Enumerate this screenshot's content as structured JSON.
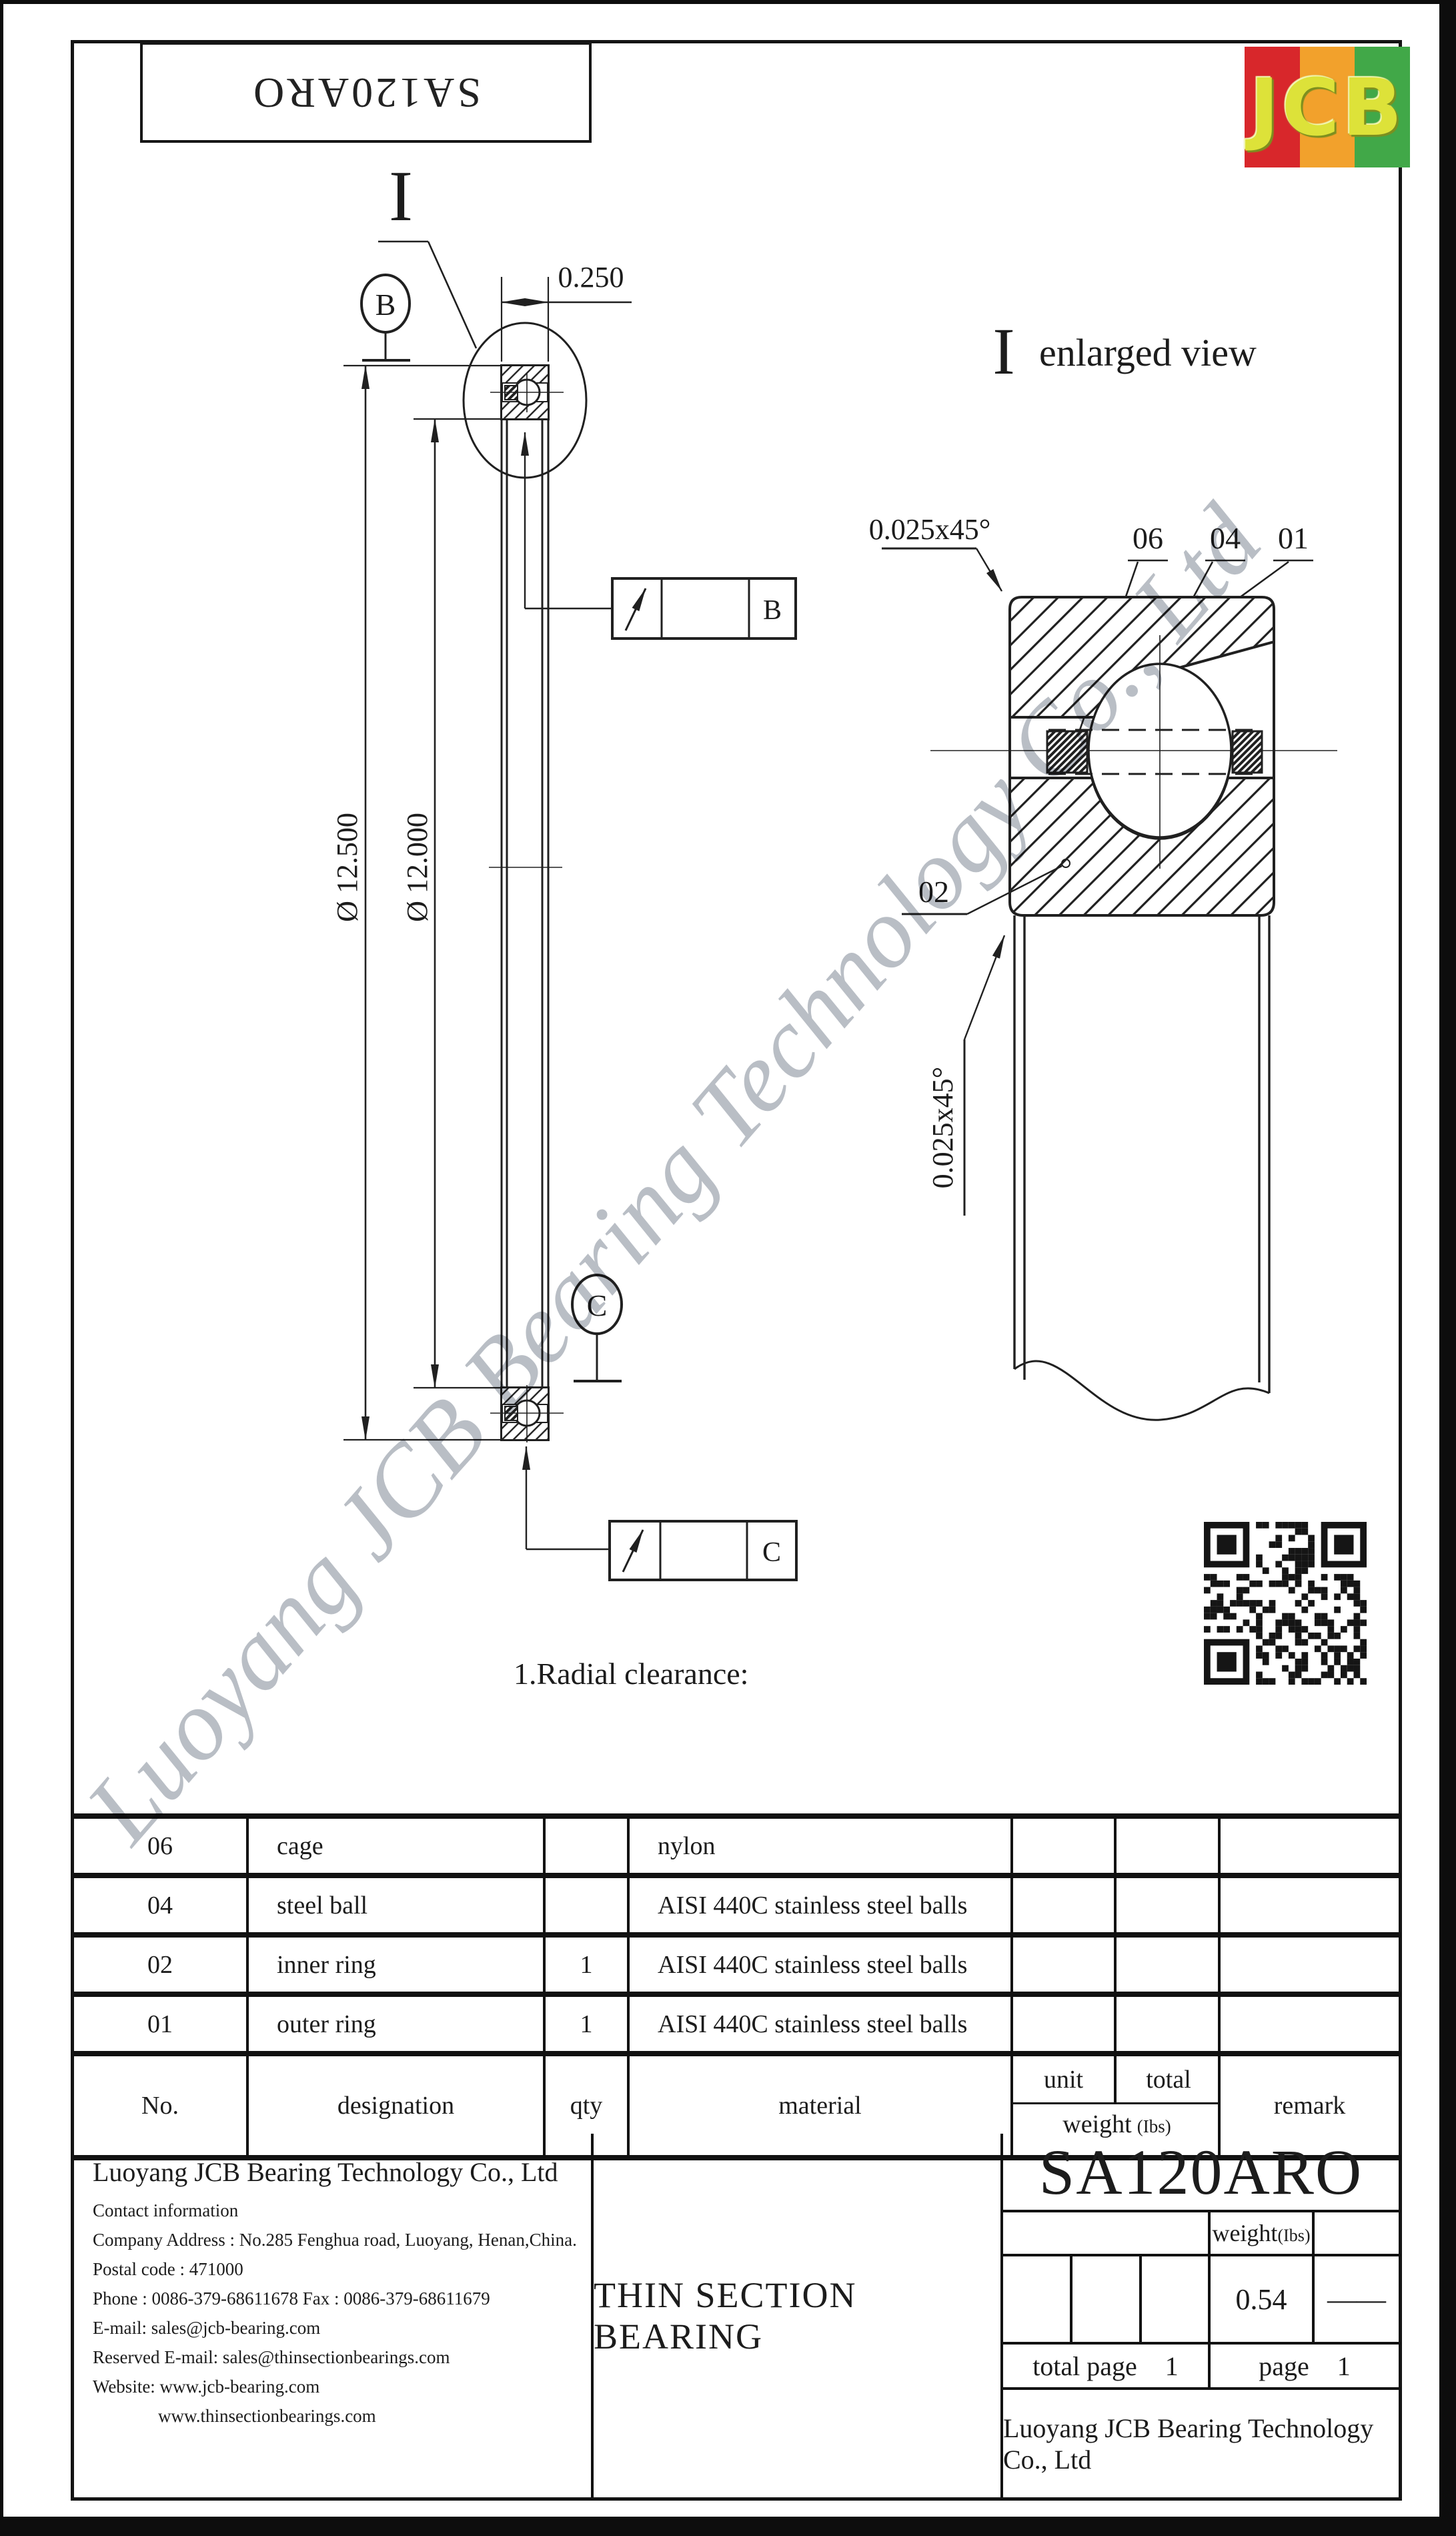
{
  "sheet": {
    "part_number_reversed": "SA120ARO",
    "logo_text": "JCB",
    "logo_stripe_colors": [
      "#d8272b",
      "#f2a12c",
      "#41a848"
    ],
    "logo_letter_color": "#dde239",
    "watermark": "Luoyang JCB Bearing Technology Co., Ltd"
  },
  "left_view": {
    "section_mark": "I",
    "balloon_b": "B",
    "balloon_c": "C",
    "flag_b_label": "B",
    "flag_c_label": "C",
    "dim_width": "0.250",
    "dim_outer_diameter": "Ø 12.500",
    "dim_bore_diameter": "Ø 12.000"
  },
  "enlarged_view": {
    "title_mark": "I",
    "title_text": "enlarged view",
    "chamfer_note_top": "0.025x45°",
    "chamfer_note_side": "0.025x45°",
    "label_cage": "06",
    "label_ball": "04",
    "label_outer_ring": "01",
    "label_inner_ring": "02"
  },
  "notes": {
    "radial_clearance": "1.Radial clearance:"
  },
  "parts_table": {
    "header": {
      "no": "No.",
      "designation": "designation",
      "qty": "qty",
      "material": "material",
      "unit": "unit",
      "total": "total",
      "weight": "weight",
      "weight_unit": "(Ibs)",
      "remark": "remark"
    },
    "rows": [
      {
        "no": "06",
        "designation": "cage",
        "qty": "",
        "material": "nylon",
        "remark": ""
      },
      {
        "no": "04",
        "designation": "steel ball",
        "qty": "",
        "material": "AISI 440C stainless steel balls",
        "remark": ""
      },
      {
        "no": "02",
        "designation": "inner ring",
        "qty": "1",
        "material": "AISI 440C stainless steel balls",
        "remark": ""
      },
      {
        "no": "01",
        "designation": "outer ring",
        "qty": "1",
        "material": "AISI 440C stainless steel balls",
        "remark": ""
      }
    ]
  },
  "title_block": {
    "company_name": "Luoyang JCB Bearing Technology Co., Ltd",
    "contact_lines": [
      "Contact information",
      "Company Address : No.285 Fenghua road, Luoyang, Henan,China.",
      "Postal code : 471000",
      "Phone : 0086-379-68611678 Fax : 0086-379-68611679",
      "E-mail: sales@jcb-bearing.com",
      "Reserved E-mail: sales@thinsectionbearings.com",
      "Website: www.jcb-bearing.com",
      "www.thinsectionbearings.com"
    ],
    "product_type": "THIN SECTION BEARING",
    "part_number": "SA120ARO",
    "weight_label": "weight",
    "weight_unit": "(Ibs)",
    "weight_value": "0.54",
    "weight_dash": "——",
    "total_page_label": "total page",
    "total_page_value": "1",
    "page_label": "page",
    "page_value": "1",
    "footer_company": "Luoyang JCB Bearing Technology Co., Ltd"
  }
}
